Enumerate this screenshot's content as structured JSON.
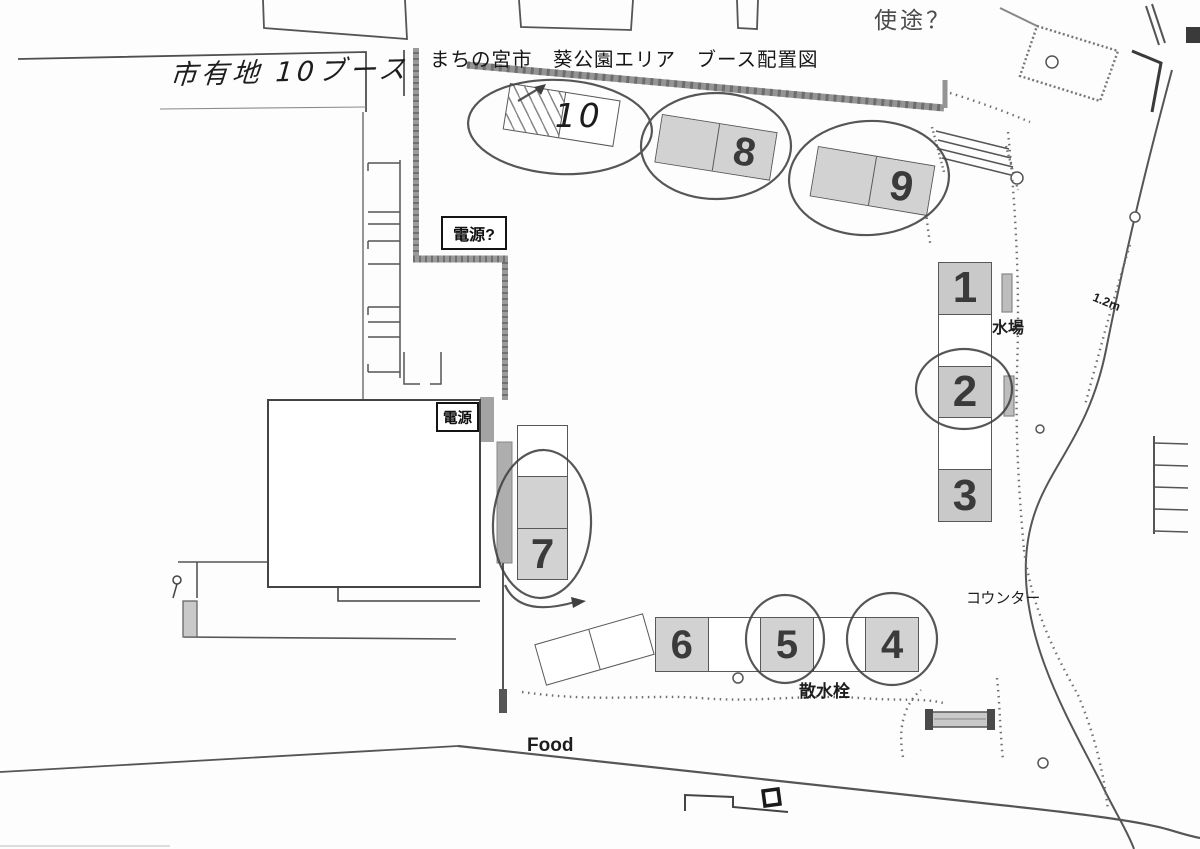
{
  "title": "まちの宮市　葵公園エリア　ブース配置図",
  "annotations": {
    "land_note": "市有地 10ブース",
    "usage_note": "使途？",
    "power_query": "電源?",
    "power": "電源",
    "water_place": "水場",
    "counter": "コウンター",
    "sprinkler_valve": "散水栓",
    "food": "Food",
    "path_width": "1.2m"
  },
  "booths": {
    "n1": {
      "label": "1",
      "shaded": true,
      "circled": false
    },
    "n2": {
      "label": "2",
      "shaded": true,
      "circled": true
    },
    "n3": {
      "label": "3",
      "shaded": true,
      "circled": false
    },
    "n4": {
      "label": "4",
      "shaded": true,
      "circled": true
    },
    "n5": {
      "label": "5",
      "shaded": true,
      "circled": true
    },
    "n6": {
      "label": "6",
      "shaded": true,
      "circled": false
    },
    "n7": {
      "label": "7",
      "shaded": true,
      "circled": true
    },
    "n8": {
      "label": "8",
      "shaded": true,
      "circled": true
    },
    "n9": {
      "label": "9",
      "shaded": true,
      "circled": true
    },
    "n10": {
      "label": "10",
      "shaded": false,
      "circled": true,
      "handwritten": true
    }
  },
  "booth_groups": {
    "top_row": [
      "10",
      "8",
      "9"
    ],
    "right_column": [
      "1",
      "2",
      "3"
    ],
    "left_column": [
      "7"
    ],
    "bottom_row": [
      "6",
      "5",
      "4"
    ]
  }
}
